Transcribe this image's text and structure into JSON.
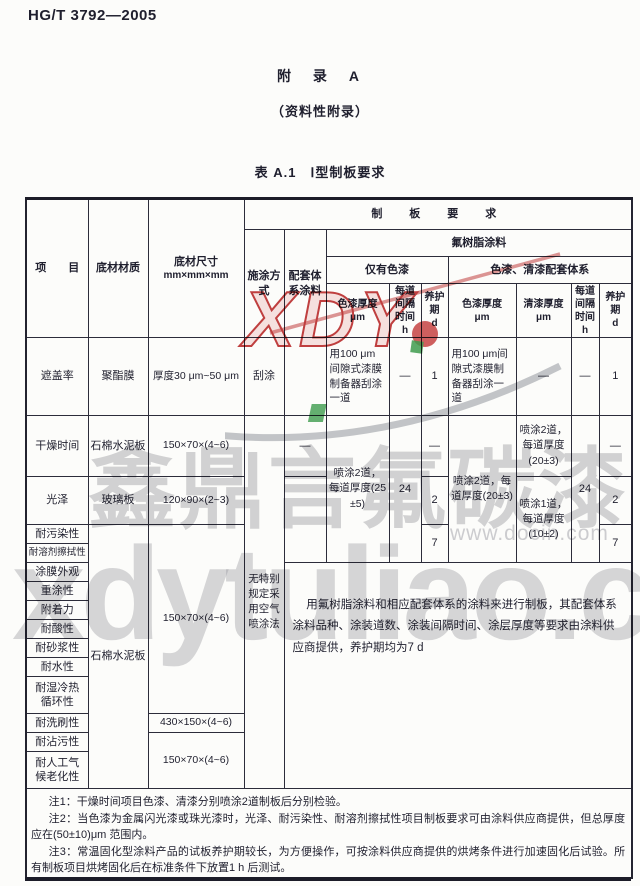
{
  "page": {
    "doc_number": "HG/T 3792—2005",
    "appendix_title": "附　录　A",
    "appendix_subtitle": "（资料性附录）",
    "table_caption": "表 A.1　Ⅰ型制板要求"
  },
  "table": {
    "head": {
      "item": "项　　目",
      "material": "底材材质",
      "size1": "底材尺寸",
      "size2": "mm×mm×mm",
      "method": "施涂方式",
      "system": "配套体系涂料",
      "requirements": "制　板　要　求",
      "fluoro": "氟树脂涂料",
      "paint_only": "仅有色漆",
      "paint_varnish": "色漆、清漆配套体系",
      "paint_thk": "色漆厚度",
      "varnish_thk": "清漆厚度",
      "interval": "每道间隔时间",
      "cure": "养护期",
      "unit_um": "μm",
      "unit_h": "h",
      "unit_d": "d"
    },
    "rows": {
      "r1": {
        "item": "遮盖率",
        "material": "聚酯膜",
        "size": "厚度30 μm~50 μm",
        "method": "刮涂",
        "paint1": "用100 μm间隙式漆膜制备器刮涂一道",
        "interval1": "—",
        "cure1": "1",
        "paint2": "用100 μm间隙式漆膜制备器刮涂一道",
        "varnish2": "—",
        "interval2": "—",
        "cure2": "1"
      },
      "r2": {
        "item": "干燥时间",
        "material": "石棉水泥板",
        "size": "150×70×(4~6)",
        "method_merged": "无特别规定采用空气喷涂法",
        "system": "—",
        "paint1": "喷涂2道，每道厚度(25±5)",
        "interval1": "24",
        "cure1": "—",
        "paint2": "喷涂2道，每道厚度(20±3)",
        "varnish2": "喷涂2道，每道厚度(20±3)",
        "interval2": "24",
        "cure2": "—"
      },
      "r3": {
        "item": "光泽",
        "material": "玻璃板",
        "size": "120×90×(2~3)",
        "cure1": "2",
        "varnish2": "喷涂1道，每道厚度(10±2)",
        "cure2": "2"
      },
      "r4": {
        "item": "耐污染性",
        "material_merged": "石棉水泥板",
        "size_merged": "150×70×(4~6)",
        "cure1": "7",
        "cure2": "7"
      },
      "r5": {
        "item": "耐溶剂擦拭性"
      },
      "r6": {
        "item": "涂膜外观",
        "panel_note": "用氟树脂涂料和相应配套体系的涂料来进行制板，其配套体系涂料品种、涂装道数、涂装间隔时间、涂层厚度等要求由涂料供应商提供，养护期均为7 d"
      },
      "r7": {
        "item": "重涂性"
      },
      "r8": {
        "item": "附着力"
      },
      "r9": {
        "item": "耐酸性"
      },
      "r10": {
        "item": "耐砂浆性"
      },
      "r11": {
        "item": "耐水性"
      },
      "r12": {
        "item": "耐湿冷热循环性"
      },
      "r13": {
        "item": "耐洗刷性",
        "size": "430×150×(4~6)"
      },
      "r14": {
        "item": "耐沾污性",
        "size_merged": "150×70×(4~6)"
      },
      "r15": {
        "item": "耐人工气候老化性"
      }
    }
  },
  "notes": [
    "注1：干燥时间项目色漆、清漆分别喷涂2道制板后分别检验。",
    "注2：当色漆为金属闪光漆或珠光漆时，光泽、耐污染性、耐溶剂擦拭性项目制板要求可由涂料供应商提供，但总厚度应在(50±10)μm 范围内。",
    "注3：常温固化型涂料产品的试板养护期较长，为方便操作，可按涂料供应商提供的烘烤条件进行加速固化后试验。所有制板项目烘烤固化后在标准条件下放置1 h 后测试。"
  ],
  "watermarks": {
    "logo": "XDY",
    "company": "鑫鼎言氟碳漆",
    "docin": "www.docin.com",
    "site": "xdytuliao.com",
    "red": "#c24040",
    "green": "#3f9e4f",
    "gray": "#9fa2a8"
  }
}
